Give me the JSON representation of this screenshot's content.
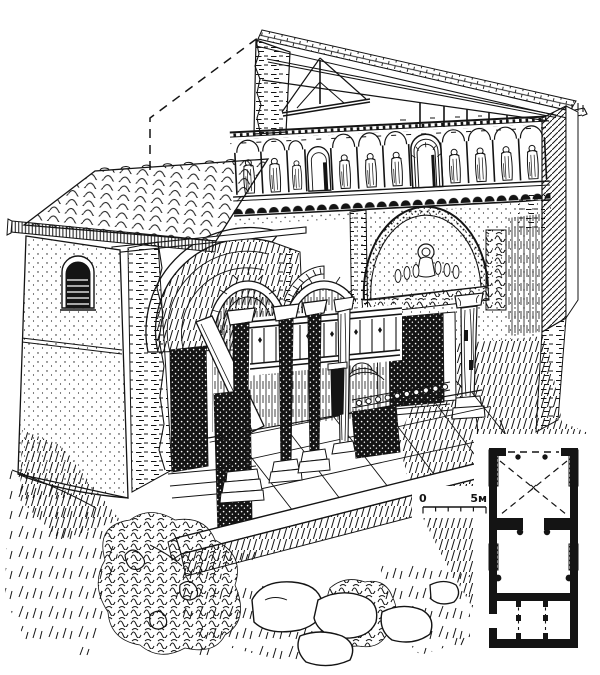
{
  "figure": {
    "description": "Black-and-white cutaway axonometric line engraving of a small medieval church: tiled narthex roof at left with a round-arched window, open timber roof above a fresco frieze of standing saints under an arcade, sectioned barrel vaults, a portal with a painted tympanum and dark doorway, interior columns and chancel screens on a paved floor, ruined masonry, rocks and bushes in the foreground",
    "colors": {
      "ink": "#141414",
      "paper": "#ffffff"
    }
  },
  "plan": {
    "scale_bar": {
      "zero_label": "0",
      "length_label": "5м"
    }
  }
}
